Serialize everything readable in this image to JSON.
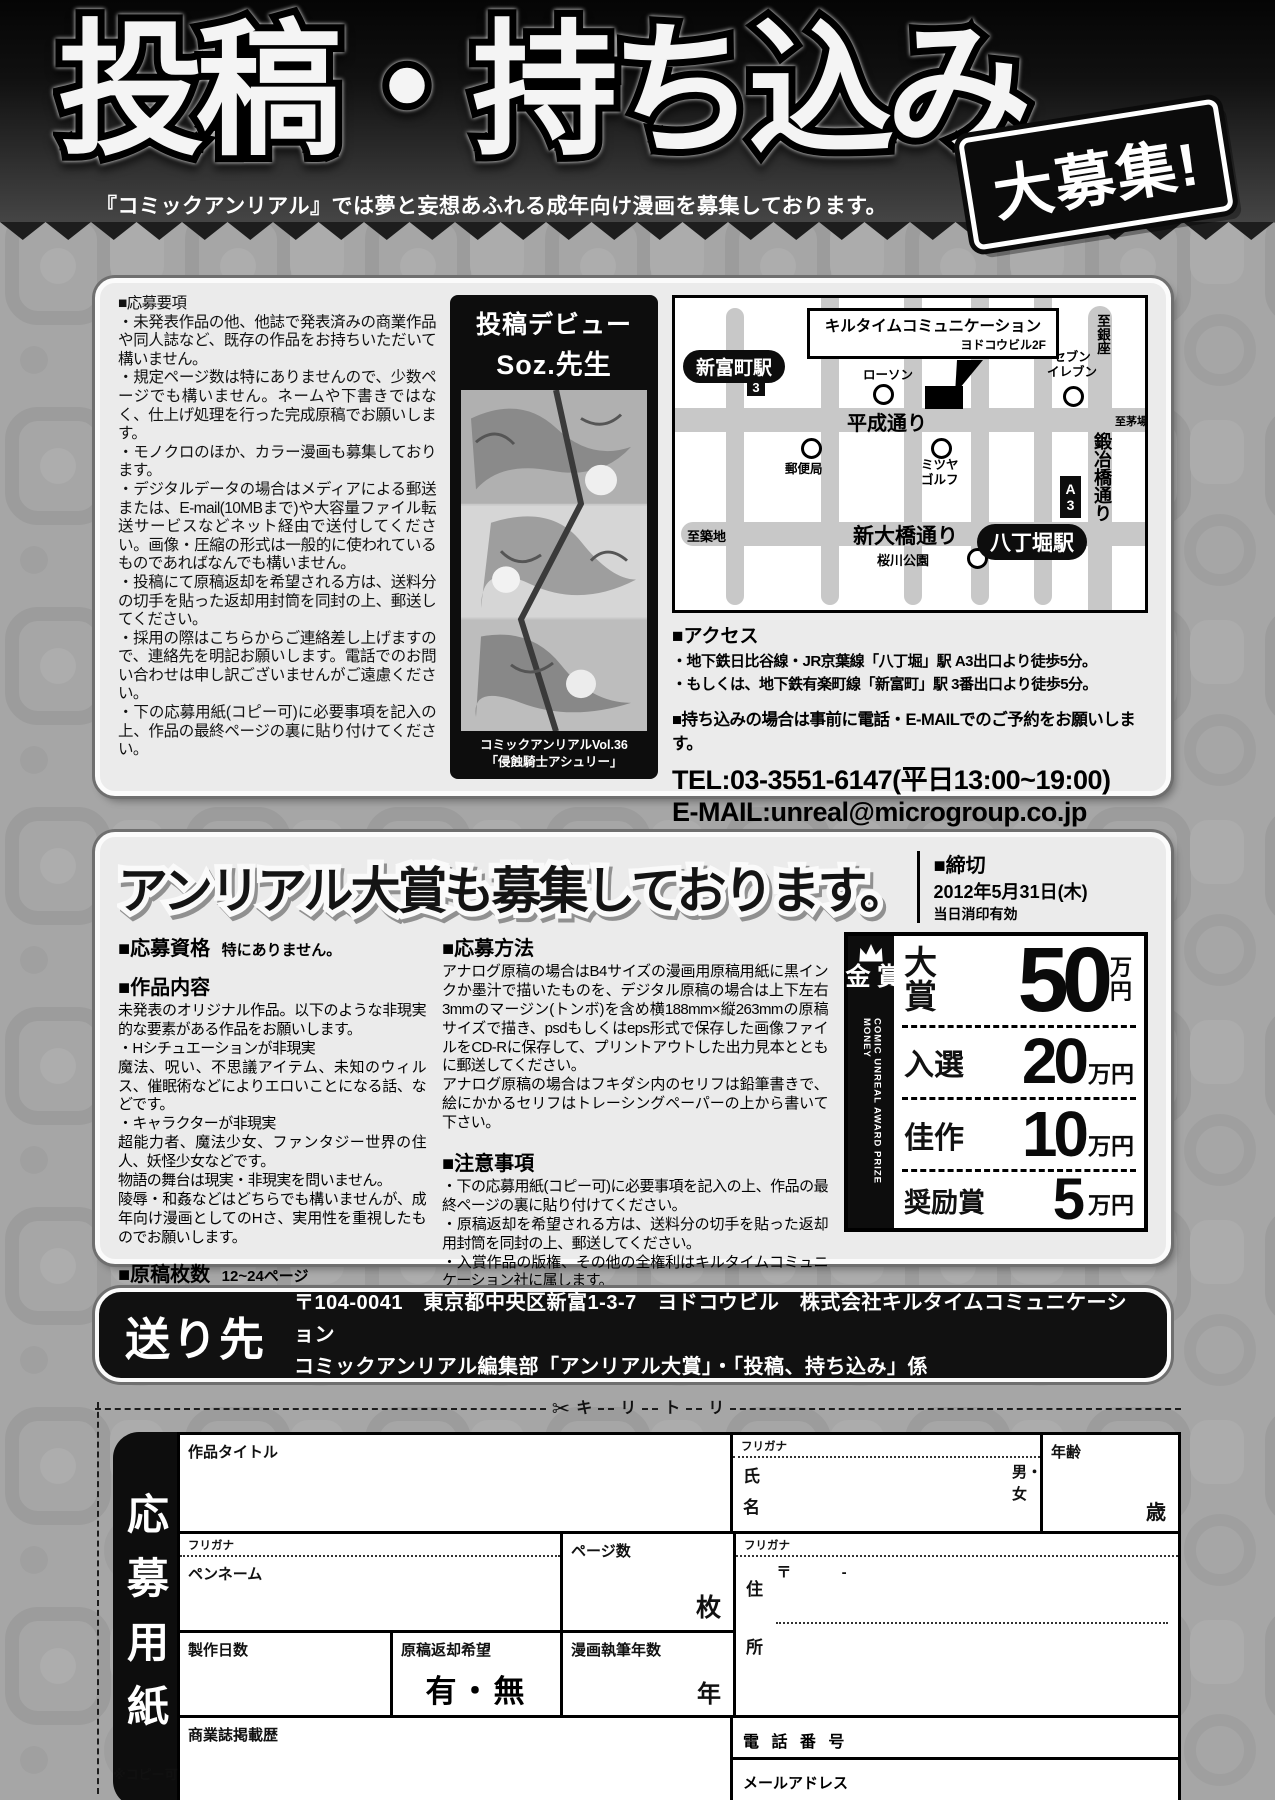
{
  "colors": {
    "page_bg": "#a6a6a6",
    "panel_bg": "#ebebeb",
    "banner_black": "#0d0d0d",
    "road_gray": "#c8c8c8"
  },
  "banner": {
    "title": "投稿・持ち込み",
    "burst": "大募集!",
    "subtitle": "『コミックアンリアル』では夢と妄想あふれる成年向け漫画を募集しております。"
  },
  "guidelines": {
    "heading": "■応募要項",
    "items": [
      "・未発表作品の他、他誌で発表済みの商業作品や同人誌など、既存の作品をお持ちいただいて構いません。",
      "・規定ページ数は特にありませんので、少数ページでも構いません。ネームや下書きではなく、仕上げ処理を行った完成原稿でお願いします。",
      "・モノクロのほか、カラー漫画も募集しております。",
      "・デジタルデータの場合はメディアによる郵送または、E-mail(10MBまで)や大容量ファイル転送サービスなどネット経由で送付してください。画像・圧縮の形式は一般的に使われているものであればなんでも構いません。",
      "・投稿にて原稿返却を希望される方は、送料分の切手を貼った返却用封筒を同封の上、郵送してください。",
      "・採用の際はこちらからご連絡差し上げますので、連絡先を明記お願いします。電話でのお問い合わせは申し訳ございませんがご遠慮ください。",
      "・下の応募用紙(コピー可)に必要事項を記入の上、作品の最終ページの裏に貼り付けてください。"
    ]
  },
  "debut": {
    "header": "投稿デビュー",
    "artist": "Soz.先生",
    "caption1": "コミックアンリアルVol.36",
    "caption2": "「侵蝕騎士アシュリー」"
  },
  "map": {
    "callout_line1": "キルタイムコミュニケーション",
    "callout_line2": "ヨドコウビル2F",
    "station_shintomicho": "新富町駅",
    "exit_3": "3",
    "lawson": "ローソン",
    "heisei_dori": "平成通り",
    "post_office": "郵便局",
    "mitsuya_line1": "ミツヤ",
    "mitsuya_line2": "ゴルフ",
    "seven_line1": "セブン",
    "seven_line2": "イレブン",
    "to_ginza": "至銀座",
    "kajibashi_dori": "鍛冶橋通り",
    "to_kayabacho": "至茅場町",
    "exit_a3": "A3",
    "shin_ohashi_dori": "新大橋通り",
    "to_tsukiji": "至築地",
    "station_hatchobori": "八丁堀駅",
    "sakuragawa_park": "桜川公園"
  },
  "access": {
    "heading": "■アクセス",
    "lines": [
      "・地下鉄日比谷線・JR京葉線「八丁堀」駅 A3出口より徒歩5分。",
      "・もしくは、地下鉄有楽町線「新富町」駅 3番出口より徒歩5分。"
    ],
    "reserve_note": "■持ち込みの場合は事前に電話・E-MAILでのご予約をお願いします。",
    "tel": "TEL:03-3551-6147(平日13:00~19:00)",
    "email": "E-MAIL:unreal@microgroup.co.jp"
  },
  "award": {
    "heading": "アンリアル大賞も募集しております。",
    "deadline_heading": "■締切",
    "deadline_date": "2012年5月31日(木)",
    "deadline_note": "当日消印有効",
    "qualification_heading": "■応募資格",
    "qualification": "特にありません。",
    "content_heading": "■作品内容",
    "content_lines": [
      "未発表のオリジナル作品。以下のような非現実的な要素がある作品をお願いします。",
      "・Hシチュエーションが非現実",
      "魔法、呪い、不思議アイテム、未知のウィルス、催眠術などによりエロいことになる話、などです。",
      "・キャラクターが非現実",
      "超能力者、魔法少女、ファンタジー世界の住人、妖怪少女などです。",
      "物語の舞台は現実・非現実を問いません。",
      "陵辱・和姦などはどちらでも構いませんが、成年向け漫画としてのHさ、実用性を重視したものでお願いします。"
    ],
    "pages_heading": "■原稿枚数",
    "pages_value": "12~24ページ",
    "method_heading": "■応募方法",
    "method_paras": [
      "アナログ原稿の場合はB4サイズの漫画用原稿用紙に黒インクか墨汁で描いたものを、デジタル原稿の場合は上下左右3mmのマージン(トンボ)を含め横188mm×縦263mmの原稿サイズで描き、psdもしくはeps形式で保存した画像ファイルをCD-Rに保存して、プリントアウトした出力見本とともに郵送してください。",
      "アナログ原稿の場合はフキダシ内のセリフは鉛筆書きで、絵にかかるセリフはトレーシングペーパーの上から書いて下さい。"
    ],
    "notes_heading": "■注意事項",
    "notes": [
      "・下の応募用紙(コピー可)に必要事項を記入の上、作品の最終ページの裏に貼り付けてください。",
      "・原稿返却を希望される方は、送料分の切手を貼った返却用封筒を同封の上、郵送してください。",
      "・入賞作品の版権、その他の全権利はキルタイムコミュニケーション社に属します。"
    ],
    "prize_bar_label": "賞金",
    "prize_bar_english": "COMIC UNREAL AWARD PRIZE MONEY",
    "prizes": [
      {
        "rank": "大賞",
        "amount": "50",
        "unit": "万円"
      },
      {
        "rank": "入選",
        "amount": "20",
        "unit": "万円"
      },
      {
        "rank": "佳作",
        "amount": "10",
        "unit": "万円"
      },
      {
        "rank": "奨励賞",
        "amount": "5",
        "unit": "万円"
      }
    ]
  },
  "address": {
    "label": "送り先",
    "line1": "〒104-0041　東京都中央区新富1-3-7　ヨドコウビル　株式会社キルタイムコミュニケーション",
    "line2": "コミックアンリアル編集部「アンリアル大賞」・「投稿、持ち込み」係"
  },
  "cutline": {
    "scissors": "✂",
    "chars": [
      "キ",
      "リ",
      "ト",
      "リ"
    ]
  },
  "form": {
    "sidebar": "応募用紙",
    "furigana": "フリガナ",
    "title_label": "作品タイトル",
    "name_label": "氏名",
    "gender_label": "男・女",
    "age_label": "年齢",
    "age_unit": "歳",
    "penname_label": "ペンネーム",
    "pages_label": "ページ数",
    "pages_unit": "枚",
    "address_label": "住所",
    "postal_mark": "〒",
    "postal_dash": "-",
    "days_label": "製作日数",
    "return_label": "原稿返却希望",
    "return_options": "有・無",
    "years_label": "漫画執筆年数",
    "years_unit": "年",
    "history_label": "商業誌掲載歴",
    "phone_label": "電 話 番 号",
    "email_label": "メールアドレス",
    "copy_note": "※コピー可"
  }
}
